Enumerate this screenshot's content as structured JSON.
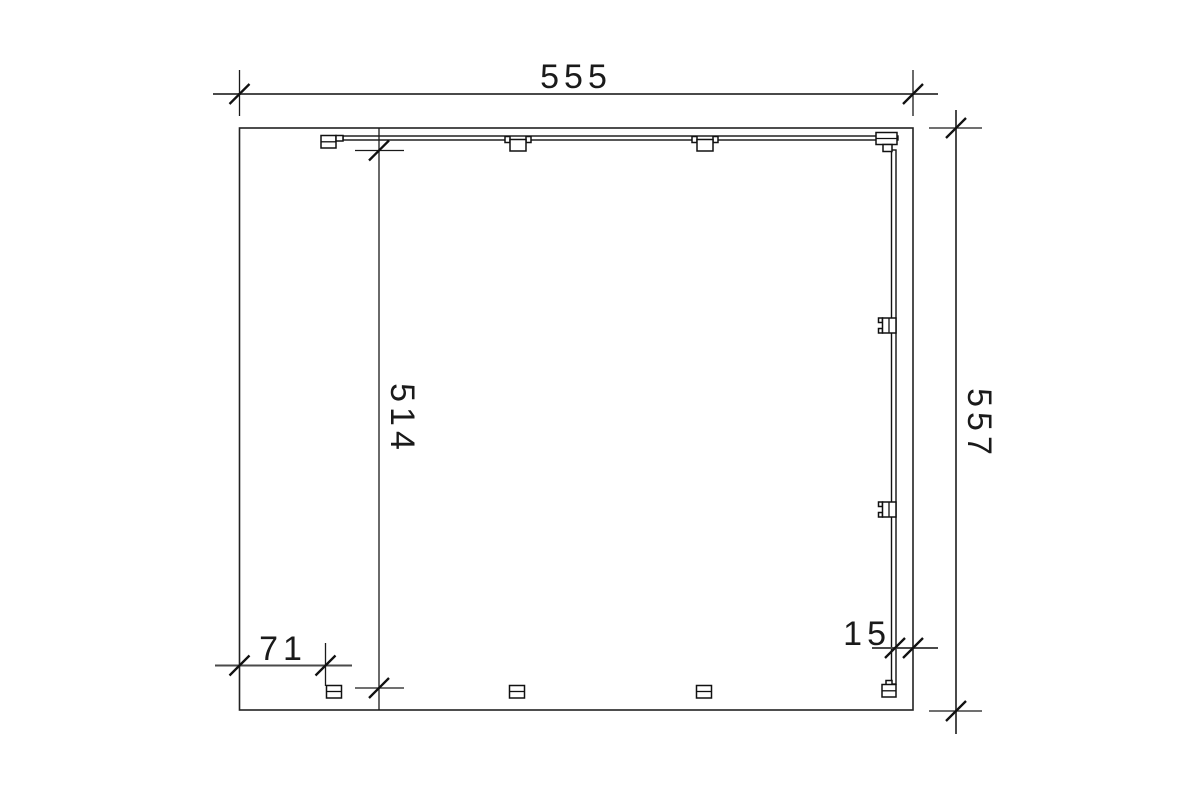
{
  "drawing": {
    "dimensions": {
      "overall_width": "555",
      "overall_height": "557",
      "inner_height": "514",
      "left_post_offset": "71",
      "right_beam_offset": "15"
    },
    "colors": {
      "line": "#1a1a1a",
      "dimension_line": "#4a4a4a",
      "background": "#ffffff"
    }
  }
}
